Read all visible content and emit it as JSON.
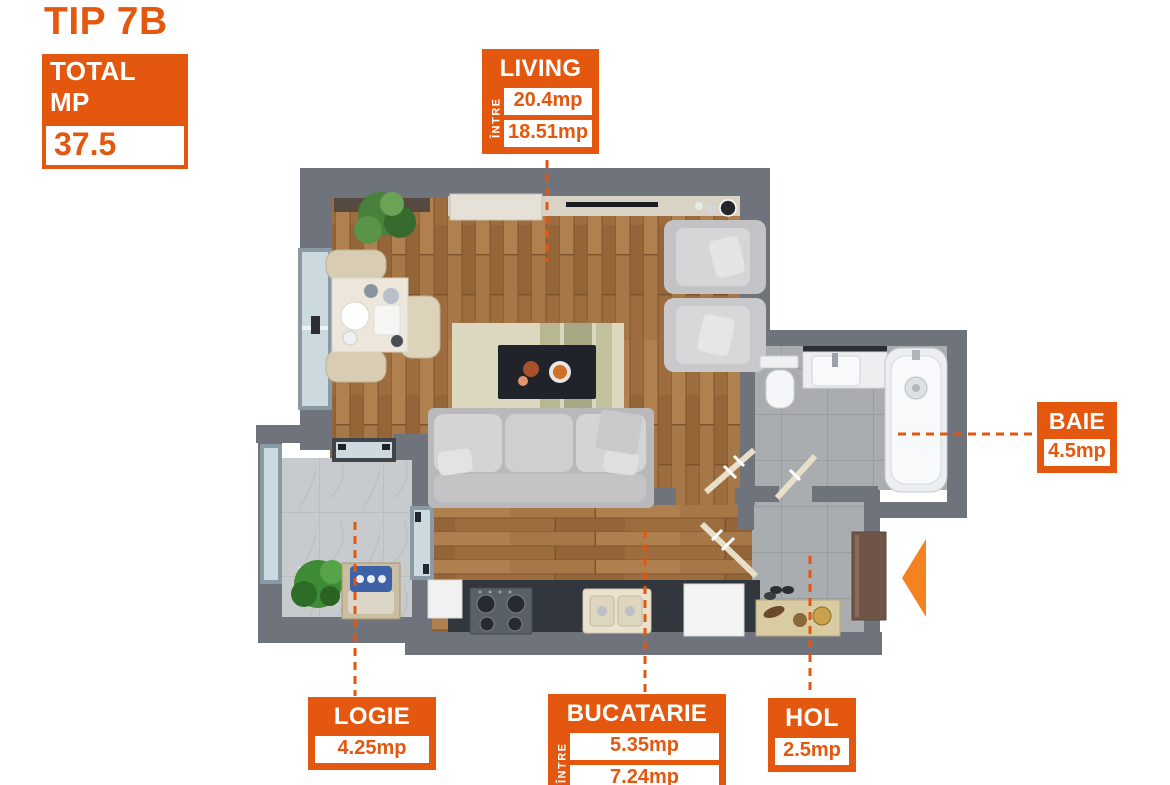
{
  "colors": {
    "accent": "#E4570F",
    "arrow": "#F58220"
  },
  "header": {
    "title": "TIP 7B",
    "total_label": "TOTAL MP",
    "total_value": "37.5"
  },
  "rooms": {
    "living": {
      "name": "LIVING",
      "range_label": "ÎNTRE",
      "values": [
        "20.4mp",
        "18.51mp"
      ]
    },
    "baie": {
      "name": "BAIE",
      "area": "4.5mp"
    },
    "logie": {
      "name": "LOGIE",
      "area": "4.25mp"
    },
    "bucatarie": {
      "name": "BUCATARIE",
      "range_label": "ÎNTRE",
      "values": [
        "5.35mp",
        "7.24mp"
      ]
    },
    "hol": {
      "name": "HOL",
      "area": "2.5mp"
    }
  }
}
